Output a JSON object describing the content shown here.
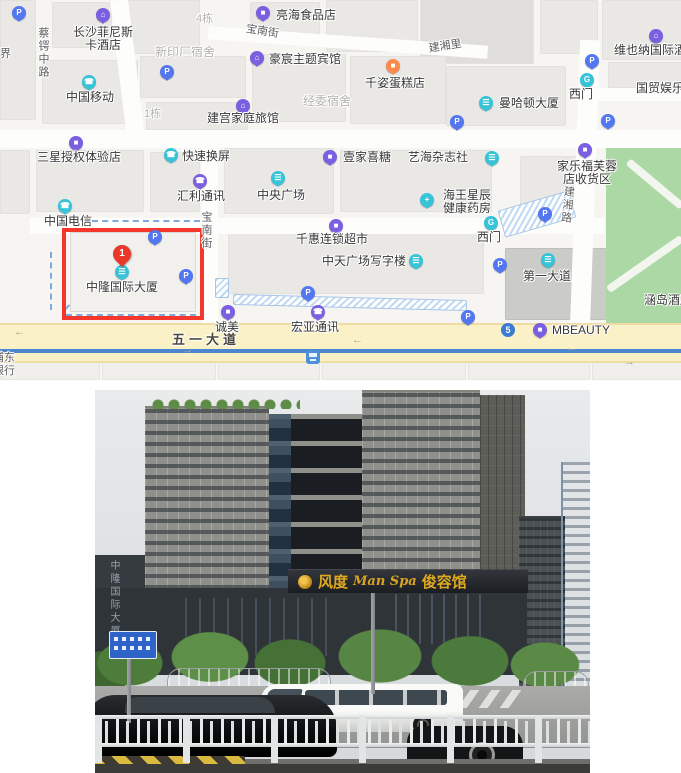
{
  "map": {
    "marker": {
      "number": "1"
    },
    "pois": [
      {
        "name": "changsha-feinisi-hotel",
        "icon": "hotel",
        "color": "purple",
        "ix": 103,
        "iy": 15,
        "lines": [
          "长沙菲尼斯",
          "卡酒店"
        ],
        "lx": 71,
        "ly": 26,
        "lw": 64
      },
      {
        "name": "lianghai-food-store",
        "icon": "shop",
        "color": "purple",
        "ix": 263,
        "iy": 13,
        "lines": [
          "亮海食品店"
        ],
        "lx": 276,
        "ly": 9
      },
      {
        "name": "haochen-theme-hotel",
        "icon": "hotel",
        "color": "purple",
        "ix": 257,
        "iy": 58,
        "lines": [
          "豪宸主题宾馆"
        ],
        "lx": 269,
        "ly": 53
      },
      {
        "name": "qianzi-cake-shop",
        "icon": "cake",
        "color": "orange",
        "ix": 393,
        "iy": 66,
        "lines": [
          "千姿蛋糕店"
        ],
        "lx": 365,
        "ly": 77
      },
      {
        "name": "vienna-international-hotel",
        "icon": "hotel",
        "color": "purple",
        "ix": 656,
        "iy": 36,
        "lines": [
          "维也纳国际酒店"
        ],
        "lx": 614,
        "ly": 44
      },
      {
        "name": "china-mobile",
        "icon": "phone",
        "color": "teal",
        "ix": 89,
        "iy": 82,
        "lines": [
          "中国移动"
        ],
        "lx": 66,
        "ly": 91
      },
      {
        "name": "jiangong-family-inn",
        "icon": "hotel",
        "color": "purple",
        "ix": 243,
        "iy": 106,
        "lines": [
          "建宫家庭旅馆"
        ],
        "lx": 207,
        "ly": 112
      },
      {
        "name": "manhattan-tower",
        "icon": "building",
        "color": "teal",
        "ix": 486,
        "iy": 103,
        "lines": [
          "曼哈顿大厦"
        ],
        "lx": 499,
        "ly": 97
      },
      {
        "name": "ximen-gate-north",
        "icon": "gate",
        "color": "teal",
        "ix": 587,
        "iy": 80,
        "lines": [
          "西门"
        ],
        "lx": 569,
        "ly": 88
      },
      {
        "name": "guomao-entertainment",
        "icon": "none",
        "color": "teal",
        "ix": 0,
        "iy": 0,
        "lines": [
          "国贸娱乐"
        ],
        "lx": 636,
        "ly": 82
      },
      {
        "name": "samsung-experience-store",
        "icon": "shop",
        "color": "purple",
        "ix": 76,
        "iy": 143,
        "lines": [
          "三星授权体验店"
        ],
        "lx": 37,
        "ly": 151
      },
      {
        "name": "kuaisu-huanping",
        "icon": "phone",
        "color": "teal",
        "ix": 171,
        "iy": 155,
        "lines": [
          "快速换屏"
        ],
        "lx": 182,
        "ly": 150
      },
      {
        "name": "huili-comm",
        "icon": "phone",
        "color": "purple",
        "ix": 200,
        "iy": 181,
        "lines": [
          "汇利通讯"
        ],
        "lx": 177,
        "ly": 190
      },
      {
        "name": "zhongyang-plaza",
        "icon": "building",
        "color": "teal",
        "ix": 278,
        "iy": 178,
        "lines": [
          "中央广场"
        ],
        "lx": 257,
        "ly": 189
      },
      {
        "name": "yijia-xitang",
        "icon": "shop",
        "color": "purple",
        "ix": 330,
        "iy": 157,
        "lines": [
          "壹家喜糖"
        ],
        "lx": 343,
        "ly": 151
      },
      {
        "name": "yihai-magazine",
        "icon": "book",
        "color": "teal",
        "ix": 492,
        "iy": 158,
        "lines": [
          "艺海杂志社"
        ],
        "lx": 408,
        "ly": 151
      },
      {
        "name": "carrefour-furong-pickup",
        "icon": "shop",
        "color": "purple",
        "ix": 585,
        "iy": 150,
        "lines": [
          "家乐福芙蓉",
          "店收货区"
        ],
        "lx": 556,
        "ly": 160,
        "lw": 62
      },
      {
        "name": "china-telecom",
        "icon": "phone",
        "color": "teal",
        "ix": 65,
        "iy": 206,
        "lines": [
          "中国电信"
        ],
        "lx": 44,
        "ly": 215
      },
      {
        "name": "neptunus-pharmacy",
        "icon": "pharmacy",
        "color": "teal",
        "ix": 427,
        "iy": 200,
        "lines": [
          "海王星辰",
          "健康药房"
        ],
        "lx": 441,
        "ly": 189,
        "lw": 52
      },
      {
        "name": "qianhui-chain-market",
        "icon": "shop",
        "color": "purple",
        "ix": 336,
        "iy": 226,
        "lines": [
          "千惠连锁超市"
        ],
        "lx": 296,
        "ly": 233
      },
      {
        "name": "ximen-gate-west",
        "icon": "gate",
        "color": "teal",
        "ix": 491,
        "iy": 223,
        "lines": [
          "西门"
        ],
        "lx": 477,
        "ly": 231
      },
      {
        "name": "zhongtian-office-tower",
        "icon": "building",
        "color": "teal",
        "ix": 416,
        "iy": 261,
        "lines": [
          "中天广场写字楼"
        ],
        "lx": 322,
        "ly": 255
      },
      {
        "name": "diyi-dadao",
        "icon": "building",
        "color": "teal",
        "ix": 548,
        "iy": 260,
        "lines": [
          "第一大道"
        ],
        "lx": 523,
        "ly": 270
      },
      {
        "name": "zhonglong-tower",
        "icon": "building",
        "color": "teal",
        "ix": 122,
        "iy": 272,
        "lines": [
          "中隆国际大厦"
        ],
        "lx": 86,
        "ly": 281
      },
      {
        "name": "chengmei",
        "icon": "shop",
        "color": "purple",
        "ix": 228,
        "iy": 312,
        "lines": [
          "诚美"
        ],
        "lx": 215,
        "ly": 321
      },
      {
        "name": "hongya-comm",
        "icon": "phone",
        "color": "purple",
        "ix": 318,
        "iy": 312,
        "lines": [
          "宏亚通讯"
        ],
        "lx": 291,
        "ly": 321
      },
      {
        "name": "mbeauty",
        "icon": "shop",
        "color": "purple",
        "ix": 540,
        "iy": 330,
        "lines": [
          "MBEAUTY"
        ],
        "lx": 552,
        "ly": 324
      },
      {
        "name": "handao-hotel",
        "icon": "none",
        "color": "teal",
        "ix": 0,
        "iy": 0,
        "lines": [
          "涵岛酒店"
        ],
        "lx": 644,
        "ly": 294
      }
    ],
    "parkings": [
      {
        "x": 19,
        "y": 13
      },
      {
        "x": 167,
        "y": 72
      },
      {
        "x": 457,
        "y": 122
      },
      {
        "x": 592,
        "y": 61
      },
      {
        "x": 608,
        "y": 121
      },
      {
        "x": 545,
        "y": 214
      },
      {
        "x": 155,
        "y": 237
      },
      {
        "x": 186,
        "y": 276
      },
      {
        "x": 308,
        "y": 293
      },
      {
        "x": 500,
        "y": 265
      },
      {
        "x": 468,
        "y": 317
      }
    ],
    "street_labels": [
      {
        "name": "street-caie-middle-road",
        "text": "蔡锷中路",
        "x": 36,
        "y": 27,
        "cls": "street vert"
      },
      {
        "name": "label-jie",
        "text": "界",
        "x": 0,
        "y": 48,
        "cls": "street"
      },
      {
        "name": "area-xinyinchang-dorm",
        "text": "新印厂宿舍",
        "x": 155,
        "y": 46,
        "cls": "area"
      },
      {
        "name": "area-building-4",
        "text": "4栋",
        "x": 196,
        "y": 13,
        "cls": "area sm"
      },
      {
        "name": "street-baonan-top",
        "text": "宝南街",
        "x": 247,
        "y": 23,
        "cls": "street",
        "rot": 9
      },
      {
        "name": "street-jianxiangli",
        "text": "建湘里",
        "x": 428,
        "y": 43,
        "cls": "street",
        "rot": -9
      },
      {
        "name": "area-jingwei-dorm",
        "text": "经委宿舍",
        "x": 303,
        "y": 95,
        "cls": "area"
      },
      {
        "name": "area-building-1",
        "text": "1栋",
        "x": 144,
        "y": 108,
        "cls": "area sm"
      },
      {
        "name": "street-baonan-vertical",
        "text": "宝南街",
        "x": 199,
        "y": 211,
        "cls": "street vert"
      },
      {
        "name": "street-jianxiang-road",
        "text": "建湘路",
        "x": 562,
        "y": 185,
        "cls": "street vert",
        "rot": 6
      },
      {
        "name": "road-wuyi-avenue",
        "text": "五一大道",
        "x": 172,
        "y": 333,
        "cls": "roadlbl"
      },
      {
        "name": "label-pudong",
        "text": "浦东",
        "x": -7,
        "y": 352,
        "cls": "street"
      },
      {
        "name": "label-bank",
        "text": "银行",
        "x": -7,
        "y": 365,
        "cls": "street"
      }
    ],
    "arrows": [
      {
        "x": 14,
        "y": 326,
        "g": "←"
      },
      {
        "x": 182,
        "y": 344,
        "g": "→"
      },
      {
        "x": 352,
        "y": 334,
        "g": "←"
      },
      {
        "x": 566,
        "y": 342,
        "g": "←"
      },
      {
        "x": 624,
        "y": 356,
        "g": "→"
      }
    ],
    "badges": {
      "metro5": {
        "text": "5"
      }
    }
  },
  "photo": {
    "sign_brand": "风度",
    "sign_script": "Man Spa",
    "sign_suffix": "俊容馆",
    "vertical_sign": "中隆国际大厦"
  }
}
